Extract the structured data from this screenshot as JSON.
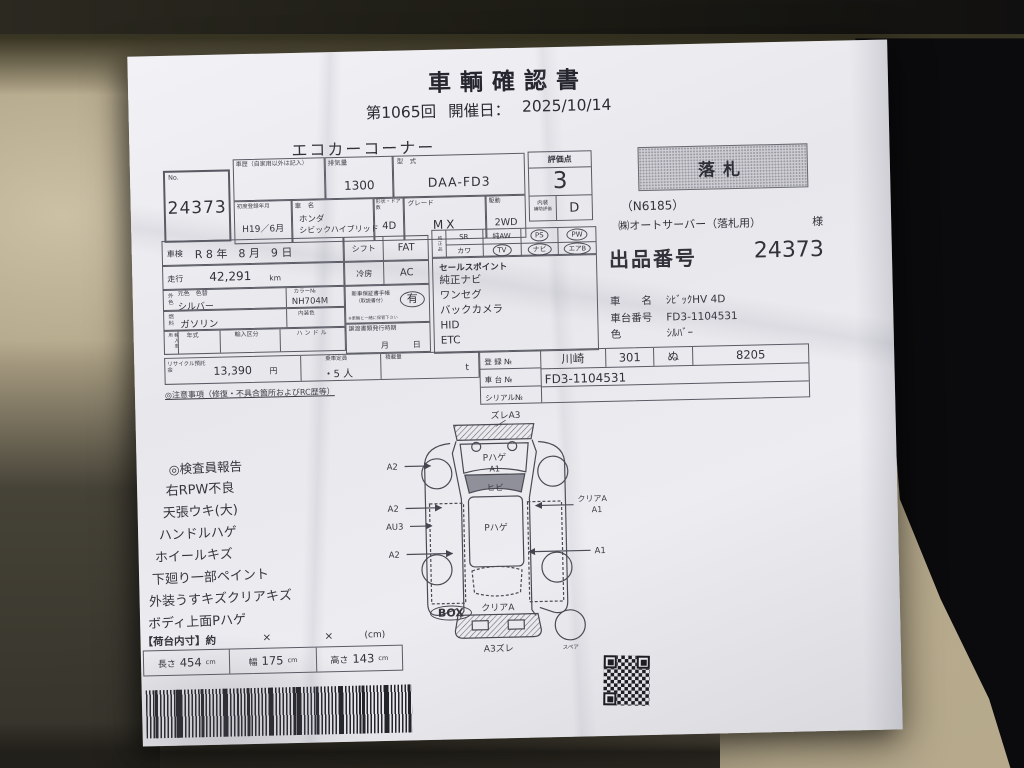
{
  "header": {
    "title": "車輌確認書",
    "round": "第1065回",
    "held_label": "開催日：",
    "date": "2025/10/14",
    "section": "エコカーコーナー"
  },
  "lot": {
    "no_label": "No.",
    "number": "24373"
  },
  "spec": {
    "history_label": "車歴（自家用以外は記入）",
    "disp_label": "排気量",
    "disp": "1300",
    "model_label": "型　式",
    "model": "DAA-FD3",
    "firstreg_label": "初度登録年月",
    "firstreg": "H19／6月",
    "name_label": "車　名",
    "maker": "ホンダ",
    "name": "シビックハイブリッド",
    "doors_label": "形状・ドア数",
    "doors": "4D",
    "grade_label": "グレード",
    "grade": "MX",
    "drive_label": "駆動",
    "drive": "2WD"
  },
  "rating": {
    "label": "評価点",
    "score": "3",
    "interior_label": "内装",
    "interior_sub": "補助評価",
    "interior": "D"
  },
  "detail": {
    "shaken_label": "車検",
    "shaken": "R 8 年　8 月　9 日",
    "run_label": "走行",
    "run": "42,291",
    "run_unit": "km",
    "color_label": "外色",
    "color_heads": "元色　色替",
    "color": "シルバー",
    "colorno_label": "カラー№",
    "colorno": "NH704M",
    "fuel_label": "燃料",
    "fuel": "ガソリン",
    "intcolor_label": "内装色",
    "import_label": "輸入車用",
    "year_label": "年式",
    "importclass_label": "輸入区分",
    "handle_label": "ハンドル",
    "recycle_label": "リサイクル預託金",
    "recycle": "13,390",
    "recycle_unit": "円",
    "seats_label": "乗車定員",
    "seats": "・5 人",
    "load_label": "積載量",
    "load_unit": "t",
    "caution": "◎注意事項（修復・不具合箇所およびRC歴等）"
  },
  "mid": {
    "shift_label": "シフト",
    "shift": "FAT",
    "ac_label": "冷房",
    "ac": "AC",
    "warranty_label": "新車保証書手帳",
    "warranty_sub": "（取説書付）",
    "warranty": "有",
    "warranty_note": "※車輌と一緒に保管下さい",
    "transfer_label": "譲渡書類発行時期",
    "month": "月",
    "day": "日"
  },
  "oem": {
    "label": "純正品",
    "sr": "SR",
    "kawa": "カワ",
    "aw": "純AW",
    "tv": "TV",
    "ps": "PS",
    "navi": "ナビ",
    "pw": "PW",
    "airb": "エアB"
  },
  "sales": {
    "label": "セールスポイント",
    "items": [
      "純正ナビ",
      "ワンセグ",
      "バックカメラ",
      "HID",
      "ETC"
    ]
  },
  "reg": {
    "reg_label": "登 録 №",
    "area": "川崎",
    "cls": "301",
    "kana": "ぬ",
    "num": "8205",
    "chassis_label": "車 台 №",
    "chassis": "FD3-1104531",
    "serial_label": "シリアル№",
    "serial": ""
  },
  "award": {
    "stamp": "落札",
    "code": "（N6185）",
    "bidder": "㈱オートサーバー（落札用）",
    "honorific": "様",
    "lot_label": "出品番号",
    "lot_no": "24373",
    "name_label": "車　　名",
    "name": "ｼﾋﾞｯｸHV 4D",
    "chassis_label": "車台番号",
    "chassis": "FD3-1104531",
    "color_label": "色",
    "color": "ｼﾙﾊﾞｰ"
  },
  "inspector": {
    "title": "◎検査員報告",
    "items": [
      "右RPW不良",
      "天張ウキ(大)",
      "ハンドルハゲ",
      "ホイールキズ",
      "下廻り一部ペイント",
      "外装うすキズクリアキズ",
      "ボディ上面Pハゲ"
    ]
  },
  "diagram": {
    "top": "ズレA3",
    "hood_1": "Pハゲ",
    "hood_2": "A1",
    "windshield": "ヒビ",
    "roof": "Pハゲ",
    "left_1": "A2",
    "left_2": "A2",
    "left_3": "AU3",
    "left_4": "A2",
    "right_1": "クリアA",
    "right_2": "A1",
    "right_3": "A1",
    "rear": "クリアA",
    "bottom": "A3ズレ",
    "spare": "スペア"
  },
  "cargo": {
    "box": "BOX",
    "dims_label": "【荷台内寸】約",
    "x1": "×",
    "x2": "×",
    "unit_note": "(cm)",
    "len_label": "長さ",
    "len": "454",
    "len_unit": "cm",
    "wid_label": "幅",
    "wid": "175",
    "wid_unit": "cm",
    "hgt_label": "高さ",
    "hgt": "143",
    "hgt_unit": "cm"
  },
  "colors": {
    "paper": "#e9e9ed",
    "ink": "#32323a",
    "seat": "#b4a88b",
    "background_black": "#0b0b0d",
    "stamp_bg": "#cdcdd3"
  }
}
